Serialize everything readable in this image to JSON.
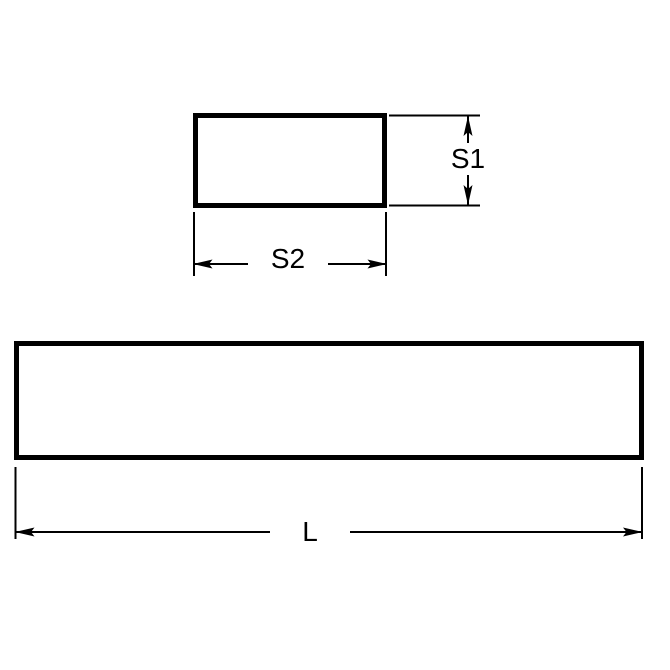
{
  "labels": {
    "s1": "S1",
    "s2": "S2",
    "l": "L"
  },
  "colors": {
    "line": "#000000",
    "text": "#000000",
    "background": "#ffffff"
  }
}
